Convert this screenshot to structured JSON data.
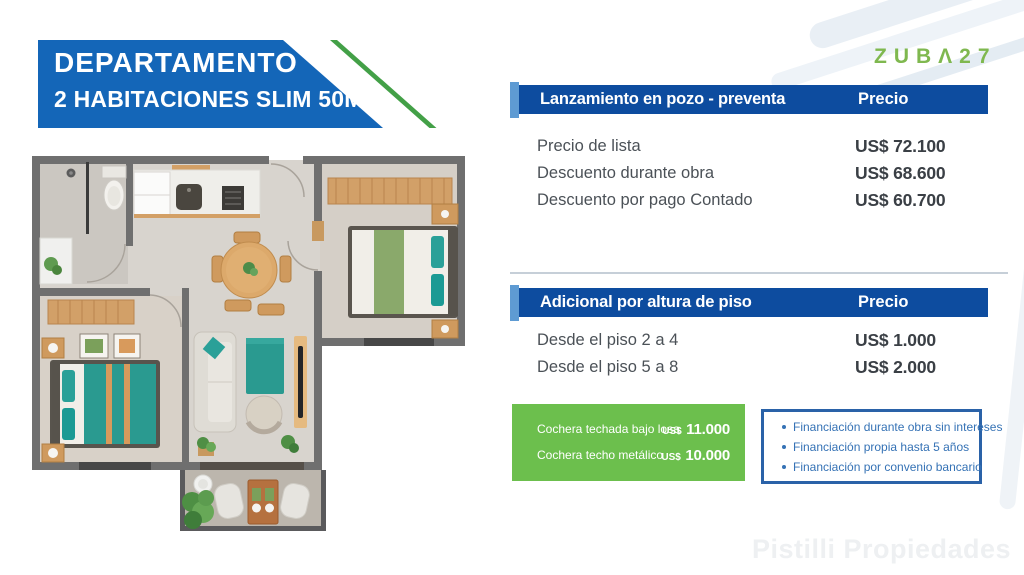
{
  "banner": {
    "line1": "DEPARTAMENTO",
    "line2": "2 HABITACIONES SLIM 50M²"
  },
  "logo": {
    "text": "ZUBΛ27"
  },
  "pricing_tables": [
    {
      "title": "Lanzamiento en pozo - preventa",
      "price_header": "Precio",
      "rows": [
        {
          "label": "Precio de lista",
          "value": "US$ 72.100"
        },
        {
          "label": "Descuento durante obra",
          "value": "US$ 68.600"
        },
        {
          "label": "Descuento por pago Contado",
          "value": "US$ 60.700"
        }
      ]
    },
    {
      "title": "Adicional por altura de piso",
      "price_header": "Precio",
      "rows": [
        {
          "label": "Desde el piso 2 a 4",
          "value": "US$ 1.000"
        },
        {
          "label": "Desde el piso 5 a 8",
          "value": "US$ 2.000"
        }
      ]
    }
  ],
  "parking_box": {
    "rows": [
      {
        "label": "Cochera techada bajo losa",
        "currency": "US$",
        "amount": "11.000"
      },
      {
        "label": "Cochera techo metálico",
        "currency": "US$",
        "amount": "10.000"
      }
    ]
  },
  "financing_box": {
    "items": [
      "Financiación durante obra sin intereses",
      "Financiación propia hasta 5 años",
      "Financiación por convenio bancario"
    ]
  },
  "watermark": {
    "text": "Pistilli Propiedades"
  },
  "colors": {
    "banner_blue": "#1466b8",
    "banner_green_edge": "#43a047",
    "logo_green": "#7fb84f",
    "table_header_blue": "#0d4c9f",
    "table_accent_light_blue": "#5e9bd3",
    "parking_green": "#6cbf4d",
    "financing_border_blue": "#2a62a8",
    "financing_text_blue": "#3572b5",
    "teal_accent": "#2a9a90"
  }
}
